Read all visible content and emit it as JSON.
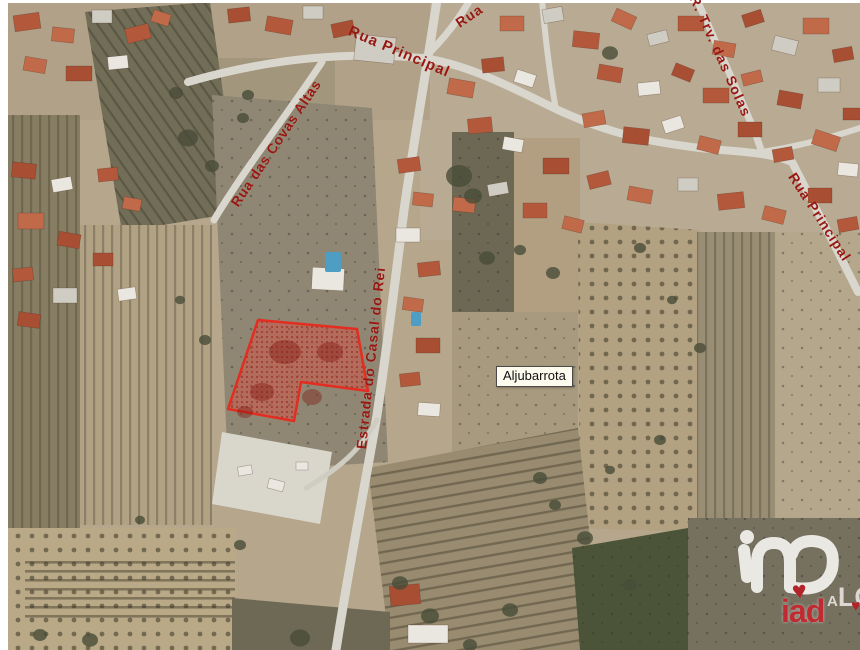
{
  "map": {
    "street_labels": {
      "rua_principal_top": "Rua Principal",
      "rua_top": "Rua",
      "covas_altas": "Rua das Covas Altas",
      "estrada_casal_rei": "Estrada do Casal do Rei",
      "trv_solas": "R. Trv. das Solas",
      "rua_principal_right": "Rua Principal"
    },
    "place_label": "Aljubarrota",
    "label_color": "#971812"
  },
  "parcel": {
    "points": "258,320 357,329 368,391 301,382 294,421 228,409",
    "stroke_color": "#e22d20",
    "fill_color": "rgba(228,70,58,0.42)",
    "hatch_dot_color": "rgba(136,14,9,0.55)"
  },
  "branding": {
    "logo_text": "iad",
    "heart_icon": "♥",
    "partial_watermark": "ALC",
    "logo_red": "#c12a30",
    "logo_white": "#f2f0ec"
  }
}
